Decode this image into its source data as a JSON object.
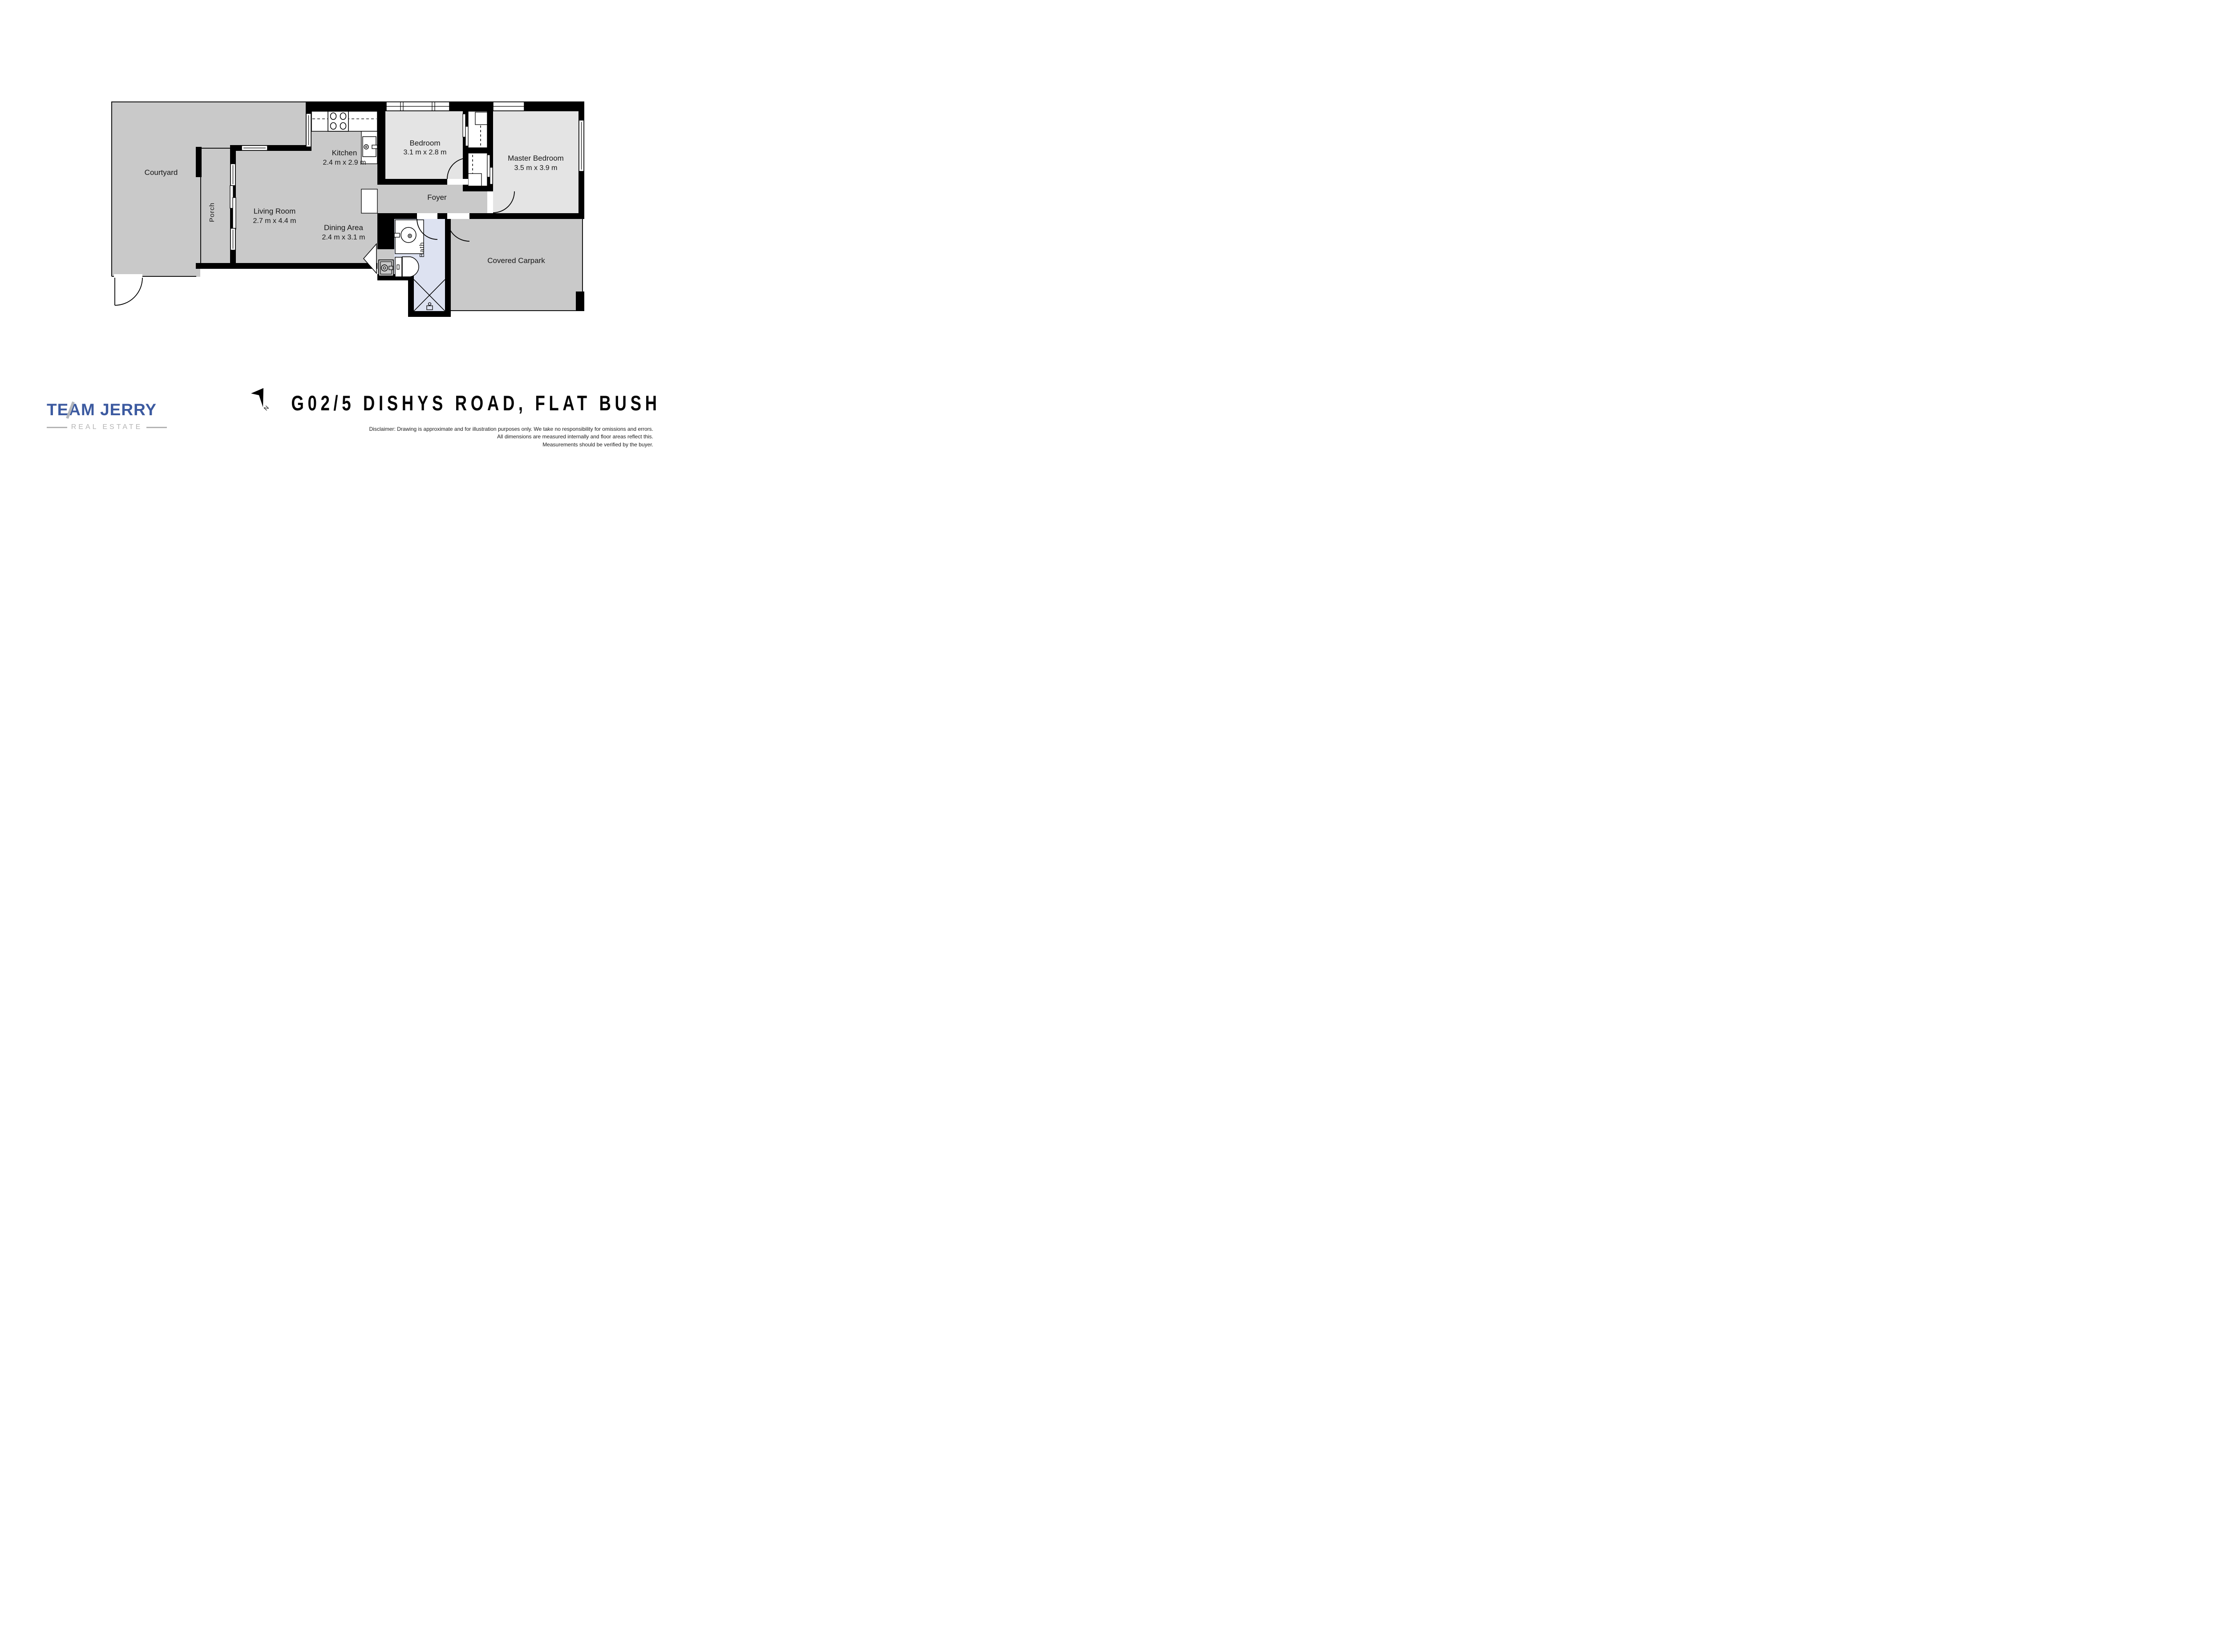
{
  "title": "G02/5 DISHYS ROAD, FLAT BUSH",
  "compass": {
    "label": "N"
  },
  "logo": {
    "name": "TEAM JERRY",
    "tagline": "REAL ESTATE",
    "blue": "#3c5aa0",
    "gray": "#b4b7bc"
  },
  "rooms": {
    "courtyard": {
      "name": "Courtyard"
    },
    "porch": {
      "name": "Porch"
    },
    "living": {
      "name": "Living Room",
      "dims": "2.7 m x 4.4 m"
    },
    "kitchen": {
      "name": "Kitchen",
      "dims": "2.4 m x 2.9 m"
    },
    "dining": {
      "name": "Dining Area",
      "dims": "2.4 m x 3.1 m"
    },
    "bedroom": {
      "name": "Bedroom",
      "dims": "3.1 m x 2.8 m"
    },
    "master": {
      "name": "Master Bedroom",
      "dims": "3.5 m x 3.9 m"
    },
    "foyer": {
      "name": "Foyer"
    },
    "bath": {
      "name": "Bath"
    },
    "carpark": {
      "name": "Covered Carpark"
    }
  },
  "disclaimer": {
    "line1": "Disclaimer: Drawing is approximate and for illustration purposes only. We take no responsibility for omissions and errors.",
    "line2": "All dimensions are measured internally and floor areas reflect this.",
    "line3": "Measurements should be verified by the buyer."
  },
  "colors": {
    "floor": "#c9c9c9",
    "room_light": "#e4e4e4",
    "bath": "#dde2f1",
    "wall": "#000000"
  }
}
